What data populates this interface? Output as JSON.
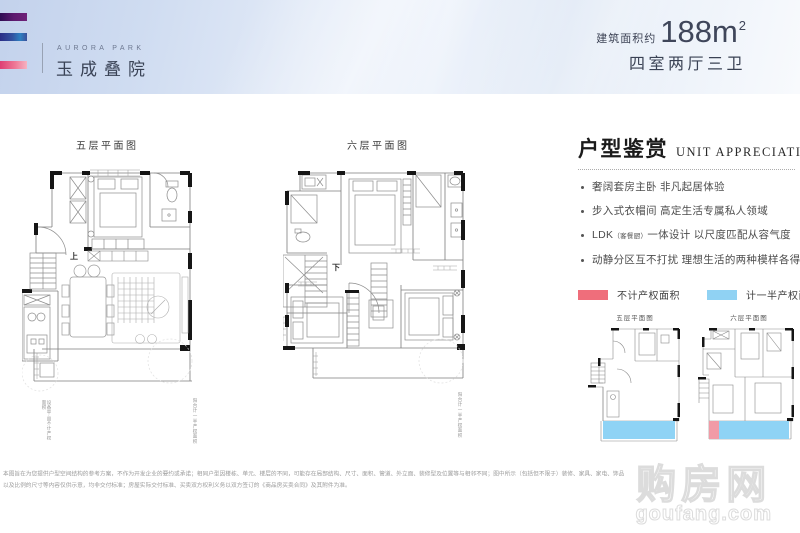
{
  "header": {
    "brand_en": "AURORA PARK",
    "brand_cn": "玉成叠院",
    "area_prefix": "建筑面积约",
    "area_number": "188m",
    "area_sup": "2",
    "rooms": "四室两厅三卫"
  },
  "plans": {
    "floor5": {
      "label": "五层平面图",
      "stair": "上"
    },
    "floor6": {
      "label": "六层平面图",
      "stair": "下"
    }
  },
  "annotations": {
    "plan5_left": "设备平台不计产权面积",
    "plan5_right": "阳台计一半产权面积",
    "plan6_right": "阳台计一半产权面积"
  },
  "panel": {
    "title_cn": "户型鉴赏",
    "title_en": "UNIT  APPRECIATION",
    "bullets": [
      {
        "text": "奢阔套房主卧 非凡起居体验"
      },
      {
        "text": "步入式衣帽间 高定生活专属私人领域"
      },
      {
        "lead": "LDK",
        "paren": "（客餐厨）",
        "text": "一体设计 以尺度匹配从容气度"
      },
      {
        "text": "动静分区互不打扰 理想生活的两种模样各得其所"
      }
    ],
    "legend": [
      {
        "label": "不计产权面积",
        "color": "#ef6e7b"
      },
      {
        "label": "计一半产权面积",
        "color": "#90d2f3"
      }
    ],
    "thumbs": [
      {
        "label": "五层平面图"
      },
      {
        "label": "六层平面图"
      }
    ]
  },
  "disclaimer": {
    "line1": "本图旨在为您提供户型空间结构的参考方案，不作为开发企业的要约或承诺；相同户型因楼栋、单元、楼层的不同，可能存在局部结构、尺寸、面积、管道、外立面、装修型及位置等与相邻不同；图中所示（包括但不限于）装修、家具、家电、饰品",
    "line2": "以及比例的尺寸等内容仅供示意，均非交付标准；房屋实际交付标准、买卖双方权利义务以双方签订的《商品房买卖合同》及其附件为准。"
  },
  "watermark": {
    "cn": "购房网",
    "en": "goufang.com"
  }
}
